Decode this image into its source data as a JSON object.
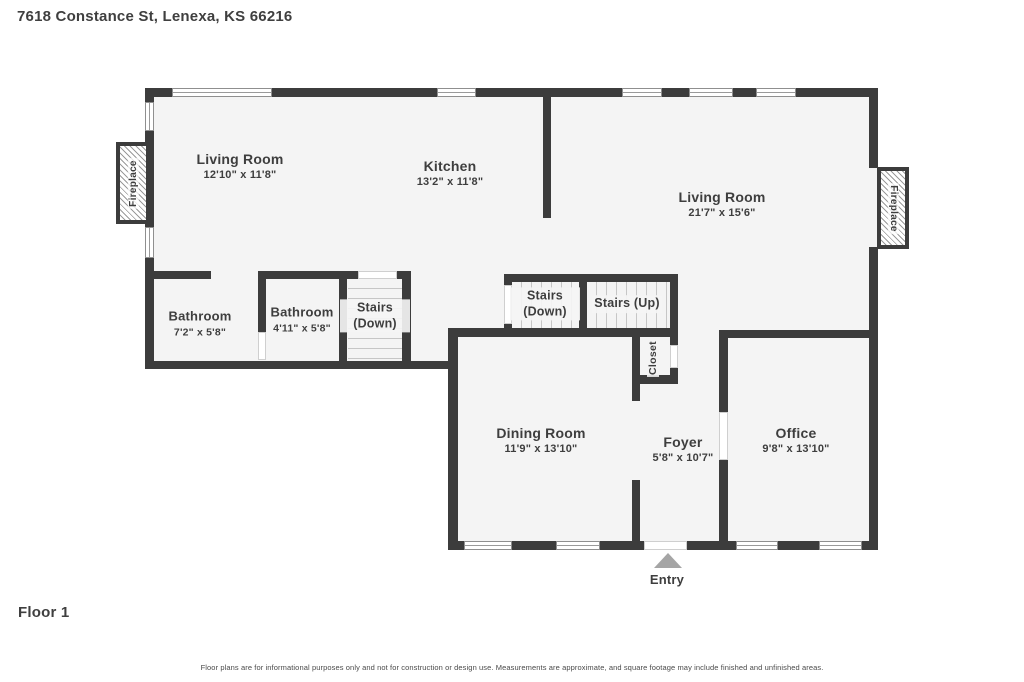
{
  "header": {
    "address": "7618 Constance St, Lenexa, KS 66216"
  },
  "floor_label": "Floor 1",
  "entry_label": "Entry",
  "disclaimer": "Floor plans are for informational purposes only and not for construction or design use. Measurements are approximate, and square footage may include finished and unfinished areas.",
  "rooms": {
    "living_left": {
      "name": "Living Room",
      "dims": "12'10\" x 11'8\""
    },
    "kitchen": {
      "name": "Kitchen",
      "dims": "13'2\" x 11'8\""
    },
    "living_right": {
      "name": "Living Room",
      "dims": "21'7\" x 15'6\""
    },
    "bathroom1": {
      "name": "Bathroom",
      "dims": "7'2\" x 5'8\""
    },
    "bathroom2": {
      "name": "Bathroom",
      "dims": "4'11\" x 5'8\""
    },
    "stairs_left": {
      "name": "Stairs (Down)"
    },
    "stairs_mid": {
      "name": "Stairs (Down)"
    },
    "stairs_up": {
      "name": "Stairs (Up)"
    },
    "closet": {
      "name": "Closet"
    },
    "dining": {
      "name": "Dining Room",
      "dims": "11'9\" x 13'10\""
    },
    "foyer": {
      "name": "Foyer",
      "dims": "5'8\" x 10'7\""
    },
    "office": {
      "name": "Office",
      "dims": "9'8\" x 13'10\""
    },
    "fireplace_left": {
      "name": "Fireplace"
    },
    "fireplace_right": {
      "name": "Fireplace"
    }
  },
  "colors": {
    "wall": "#3c3c3c",
    "floor": "#f4f4f4",
    "text": "#3e3e3e",
    "entry_arrow": "#a5a5a5"
  }
}
